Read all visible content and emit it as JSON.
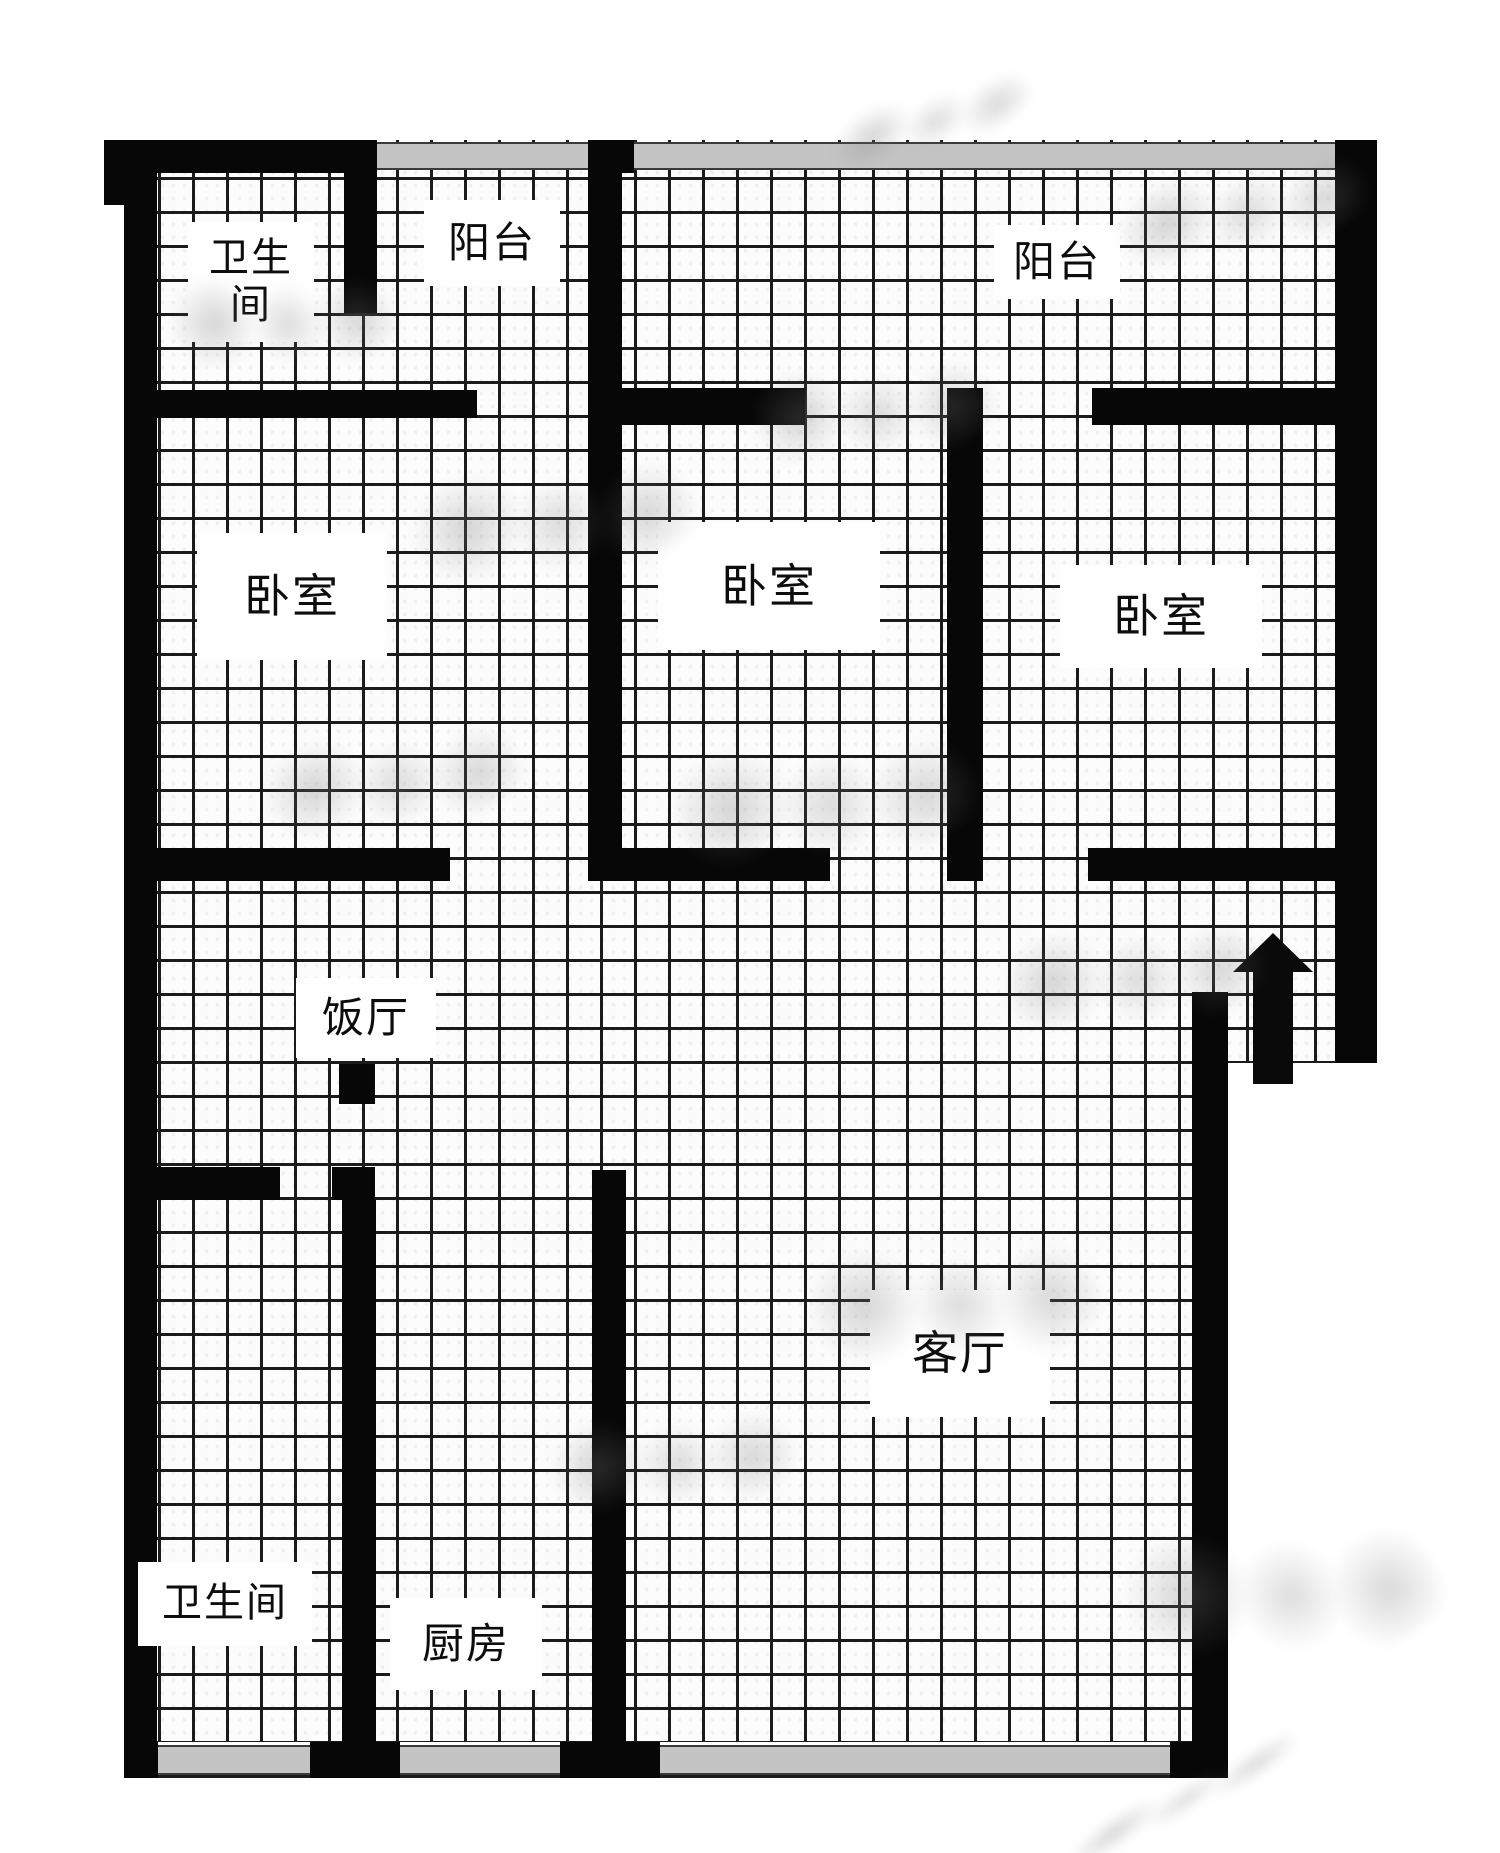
{
  "page": {
    "width": 1500,
    "height": 1853,
    "background": "#ffffff"
  },
  "floor_plan": {
    "canvas": {
      "x": 124,
      "y": 140,
      "w": 1253,
      "h": 1638
    },
    "grid": {
      "pitch_px": 34,
      "line_px": 3,
      "line_color": "#1b1b1b",
      "cell_color": "#fcfcfc"
    },
    "wall_color": "#070707",
    "window_color": "#c4c4c4",
    "rooms": [
      {
        "id": "bathroom-top",
        "label": "卫生间",
        "label_lines": [
          "卫生",
          "间"
        ],
        "box": {
          "x": 64,
          "y": 82,
          "w": 126,
          "h": 120
        },
        "font": 40
      },
      {
        "id": "balcony-left",
        "label": "阳台",
        "label_lines": [
          "阳台"
        ],
        "box": {
          "x": 300,
          "y": 60,
          "w": 136,
          "h": 86
        },
        "font": 42
      },
      {
        "id": "balcony-right",
        "label": "阳台",
        "label_lines": [
          "阳台"
        ],
        "box": {
          "x": 870,
          "y": 85,
          "w": 126,
          "h": 74
        },
        "font": 42
      },
      {
        "id": "bedroom-left",
        "label": "卧室",
        "label_lines": [
          "卧室"
        ],
        "box": {
          "x": 73,
          "y": 393,
          "w": 190,
          "h": 127
        },
        "font": 46
      },
      {
        "id": "bedroom-middle",
        "label": "卧室",
        "label_lines": [
          "卧室"
        ],
        "box": {
          "x": 534,
          "y": 382,
          "w": 222,
          "h": 128
        },
        "font": 46
      },
      {
        "id": "bedroom-right",
        "label": "卧室",
        "label_lines": [
          "卧室"
        ],
        "box": {
          "x": 936,
          "y": 425,
          "w": 202,
          "h": 103
        },
        "font": 46
      },
      {
        "id": "dining-room",
        "label": "饭厅",
        "label_lines": [
          "饭厅"
        ],
        "box": {
          "x": 172,
          "y": 838,
          "w": 140,
          "h": 80
        },
        "font": 42
      },
      {
        "id": "living-room",
        "label": "客厅",
        "label_lines": [
          "客厅"
        ],
        "box": {
          "x": 746,
          "y": 1150,
          "w": 180,
          "h": 127
        },
        "font": 46
      },
      {
        "id": "bathroom-bottom",
        "label": "卫生间",
        "label_lines": [
          "卫生间"
        ],
        "box": {
          "x": 14,
          "y": 1422,
          "w": 174,
          "h": 84
        },
        "font": 40
      },
      {
        "id": "kitchen",
        "label": "厨房",
        "label_lines": [
          "厨房"
        ],
        "box": {
          "x": 266,
          "y": 1458,
          "w": 152,
          "h": 92
        },
        "font": 42
      }
    ],
    "walls": [
      {
        "x": -20,
        "y": 0,
        "w": 20,
        "h": 65
      },
      {
        "x": 0,
        "y": 0,
        "w": 33,
        "h": 1638
      },
      {
        "x": 0,
        "y": 0,
        "w": 252,
        "h": 33
      },
      {
        "x": 476,
        "y": 0,
        "w": 34,
        "h": 33
      },
      {
        "x": 1211,
        "y": 0,
        "w": 42,
        "h": 923
      },
      {
        "x": 220,
        "y": 0,
        "w": 33,
        "h": 173
      },
      {
        "x": 0,
        "y": 250,
        "w": 353,
        "h": 28
      },
      {
        "x": 498,
        "y": 248,
        "w": 183,
        "h": 37
      },
      {
        "x": 968,
        "y": 248,
        "w": 245,
        "h": 37
      },
      {
        "x": 464,
        "y": 0,
        "w": 34,
        "h": 740
      },
      {
        "x": 823,
        "y": 248,
        "w": 36,
        "h": 493
      },
      {
        "x": 0,
        "y": 708,
        "w": 326,
        "h": 33
      },
      {
        "x": 464,
        "y": 708,
        "w": 242,
        "h": 33
      },
      {
        "x": 964,
        "y": 708,
        "w": 249,
        "h": 33
      },
      {
        "x": 215,
        "y": 924,
        "w": 36,
        "h": 40
      },
      {
        "x": 0,
        "y": 1027,
        "w": 156,
        "h": 33
      },
      {
        "x": 208,
        "y": 1027,
        "w": 43,
        "h": 33
      },
      {
        "x": 218,
        "y": 1060,
        "w": 34,
        "h": 543
      },
      {
        "x": 468,
        "y": 1030,
        "w": 34,
        "h": 573
      },
      {
        "x": 1068,
        "y": 852,
        "w": 36,
        "h": 786
      },
      {
        "x": 0,
        "y": 1602,
        "w": 34,
        "h": 36
      },
      {
        "x": 186,
        "y": 1602,
        "w": 90,
        "h": 36
      },
      {
        "x": 436,
        "y": 1602,
        "w": 100,
        "h": 36
      },
      {
        "x": 1046,
        "y": 1602,
        "w": 58,
        "h": 36
      }
    ],
    "windows": [
      {
        "x": 252,
        "y": 2,
        "w": 224,
        "h": 28
      },
      {
        "x": 510,
        "y": 2,
        "w": 701,
        "h": 28
      },
      {
        "x": 34,
        "y": 1605,
        "w": 152,
        "h": 30
      },
      {
        "x": 276,
        "y": 1605,
        "w": 160,
        "h": 30
      },
      {
        "x": 536,
        "y": 1605,
        "w": 510,
        "h": 30
      }
    ],
    "masks": [
      {
        "x": 1104,
        "y": 923,
        "w": 153,
        "h": 715
      },
      {
        "x": 0,
        "y": 1602,
        "w": 1104,
        "h": 3
      }
    ],
    "entrance_arrow": {
      "direction": "up",
      "head": {
        "x": 1109,
        "y": 793,
        "half_w": 40,
        "h": 39
      },
      "shaft": {
        "x": 1129,
        "y": 830,
        "w": 40,
        "h": 114
      },
      "color": "#0a0a0a"
    },
    "watermarks": [
      {
        "x": 830,
        "y": 75,
        "w": 200,
        "h": 90
      },
      {
        "x": 1120,
        "y": 140,
        "w": 240,
        "h": 140
      },
      {
        "x": 180,
        "y": 240,
        "w": 200,
        "h": 160
      },
      {
        "x": 420,
        "y": 430,
        "w": 260,
        "h": 180
      },
      {
        "x": 760,
        "y": 330,
        "w": 220,
        "h": 160
      },
      {
        "x": 270,
        "y": 700,
        "w": 240,
        "h": 160
      },
      {
        "x": 680,
        "y": 700,
        "w": 280,
        "h": 200
      },
      {
        "x": 1010,
        "y": 890,
        "w": 240,
        "h": 170
      },
      {
        "x": 820,
        "y": 1200,
        "w": 260,
        "h": 200
      },
      {
        "x": 1140,
        "y": 1480,
        "w": 280,
        "h": 220
      },
      {
        "x": 560,
        "y": 1380,
        "w": 220,
        "h": 160
      },
      {
        "x": 1050,
        "y": 1775,
        "w": 260,
        "h": 50
      }
    ]
  }
}
